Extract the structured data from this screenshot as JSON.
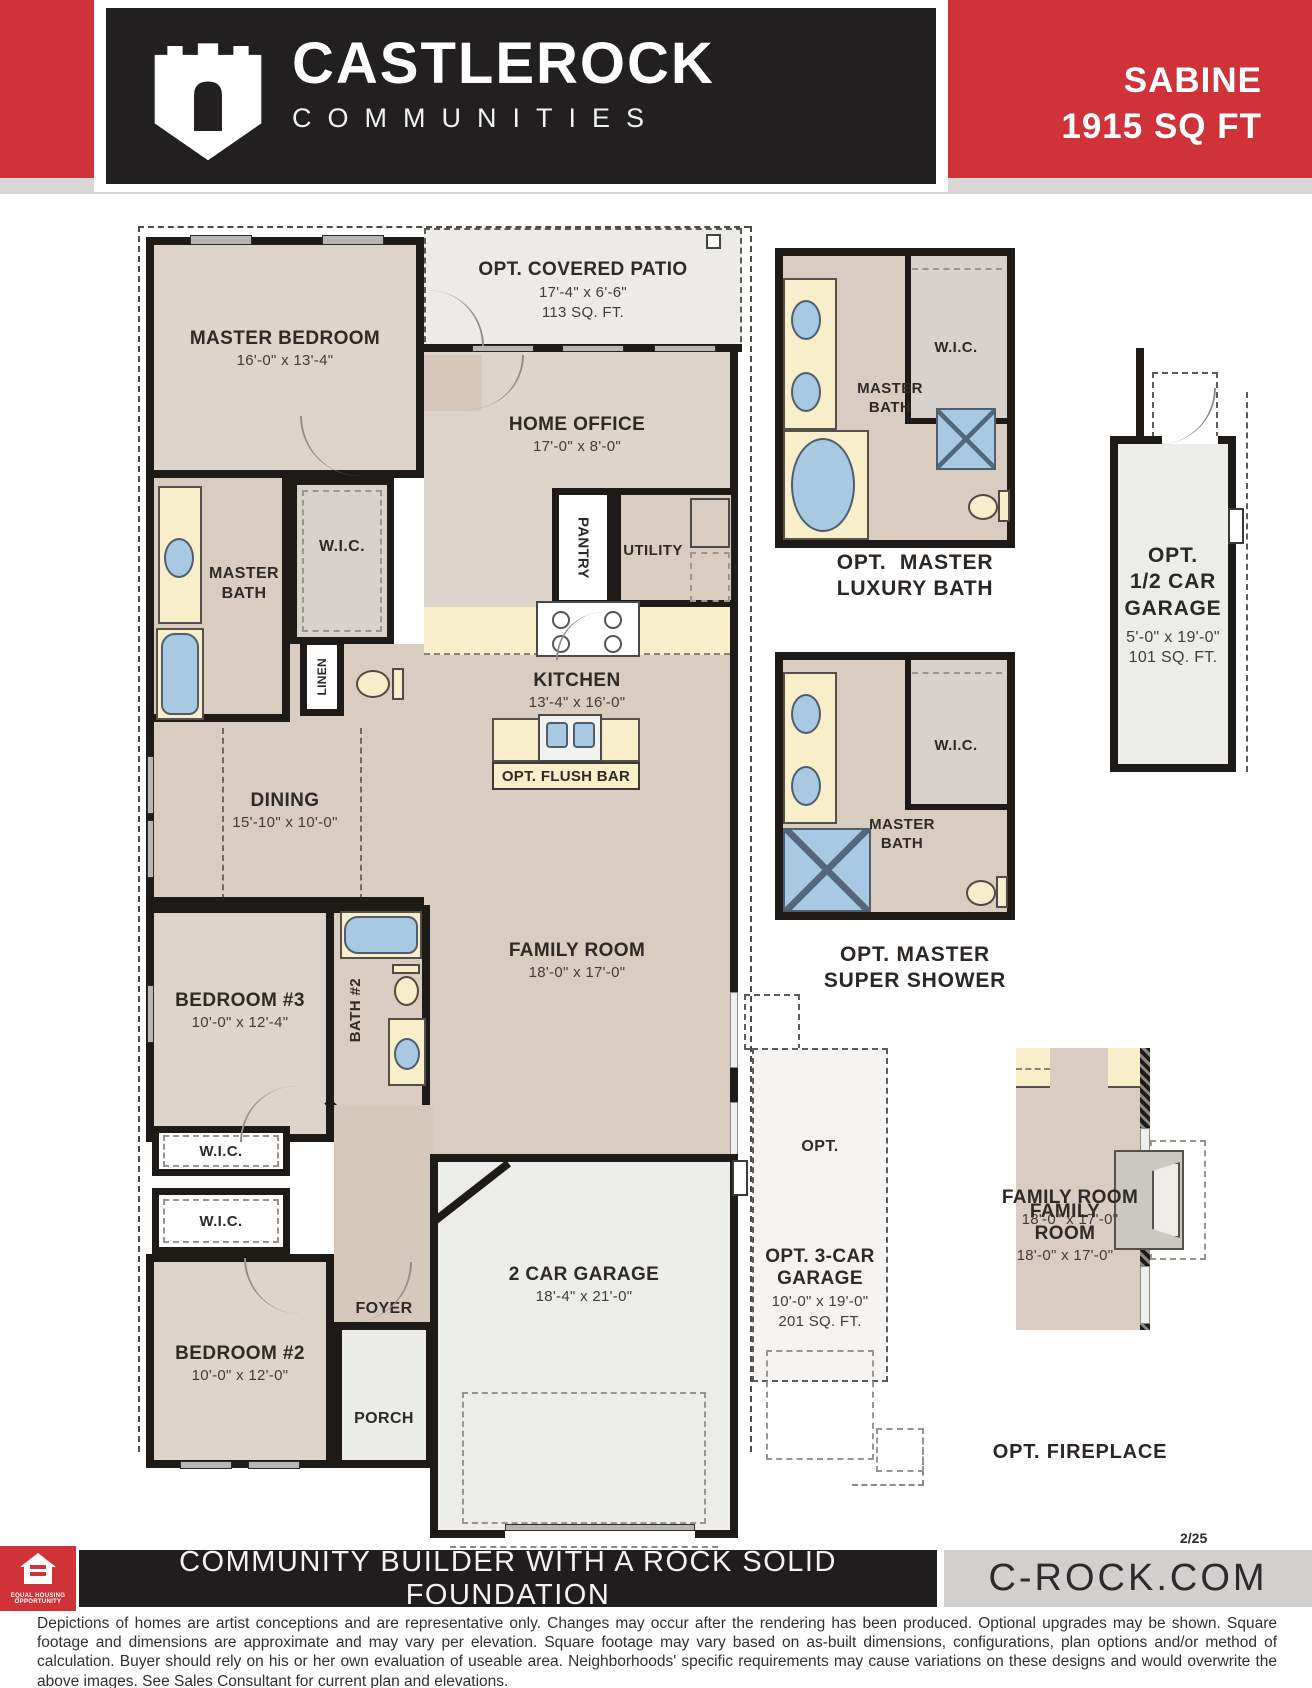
{
  "header": {
    "brand_top": "CASTLEROCK",
    "brand_bottom": "COMMUNITIES",
    "plan_name": "SABINE",
    "plan_size": "1915 SQ FT",
    "accent_red": "#cf3339",
    "charcoal": "#221f20"
  },
  "plan": {
    "master_bedroom": {
      "label": "MASTER BEDROOM",
      "dims": "16'-0\" x 13'-4\""
    },
    "covered_patio": {
      "label": "OPT. COVERED PATIO",
      "dims": "17'-4\" x 6'-6\"",
      "area": "113 SQ. FT."
    },
    "home_office": {
      "label": "HOME OFFICE",
      "dims": "17'-0\" x 8'-0\""
    },
    "master_bath": {
      "label": "MASTER BATH"
    },
    "wic": {
      "label": "W.I.C."
    },
    "linen": {
      "label": "LINEN"
    },
    "pantry": {
      "label": "PANTRY"
    },
    "utility": {
      "label": "UTILITY"
    },
    "kitchen": {
      "label": "KITCHEN",
      "dims": "13'-4\" x 16'-0\""
    },
    "flush_bar": {
      "label": "OPT. FLUSH BAR"
    },
    "dining": {
      "label": "DINING",
      "dims": "15'-10\" x 10'-0\""
    },
    "family_room": {
      "label": "FAMILY ROOM",
      "dims": "18'-0\" x 17'-0\"",
      "label_l1": "FAMILY",
      "label_l2": "ROOM"
    },
    "bedroom3": {
      "label": "BEDROOM #3",
      "dims": "10'-0\" x 12'-4\""
    },
    "bath2": {
      "label": "BATH #2"
    },
    "bedroom2": {
      "label": "BEDROOM #2",
      "dims": "10'-0\" x 12'-0\""
    },
    "foyer": {
      "label": "FOYER"
    },
    "porch": {
      "label": "PORCH"
    },
    "garage": {
      "label": "2 CAR GARAGE",
      "dims": "18'-4\" x 21'-0\""
    }
  },
  "options": {
    "luxury_bath": {
      "caption_1": "OPT.  MASTER",
      "caption_2": "LUXURY BATH"
    },
    "half_garage": {
      "line1": "OPT.",
      "line2": "1/2 CAR",
      "line3": "GARAGE",
      "dims": "5'-0\" x 19'-0\"",
      "area": "101 SQ. FT."
    },
    "super_shower": {
      "caption_1": "OPT. MASTER",
      "caption_2": "SUPER SHOWER"
    },
    "three_car": {
      "opt_tag": "OPT.",
      "line1": "OPT. 3-CAR",
      "line2": "GARAGE",
      "dims": "10'-0\" x 19'-0\"",
      "area": "201 SQ. FT."
    },
    "fireplace": {
      "caption": "OPT. FIREPLACE"
    }
  },
  "footer": {
    "rev": "2/25",
    "tagline": "COMMUNITY BUILDER WITH A ROCK SOLID FOUNDATION",
    "website": "C-ROCK.COM",
    "eho_line1": "EQUAL HOUSING",
    "eho_line2": "OPPORTUNITY",
    "disclaimer": "Depictions of homes are artist conceptions and are representative only. Changes may occur after the rendering has been produced. Optional upgrades may be shown. Square footage and dimensions are approximate and may vary per elevation. Square footage may vary based on as-built dimensions, configurations, plan options and/or method of calculation. Buyer should rely on his or her own evaluation of useable area. Neighborhoods' specific requirements may cause variations on these designs and would overwrite the above images. See Sales Consultant for current plan and elevations."
  }
}
